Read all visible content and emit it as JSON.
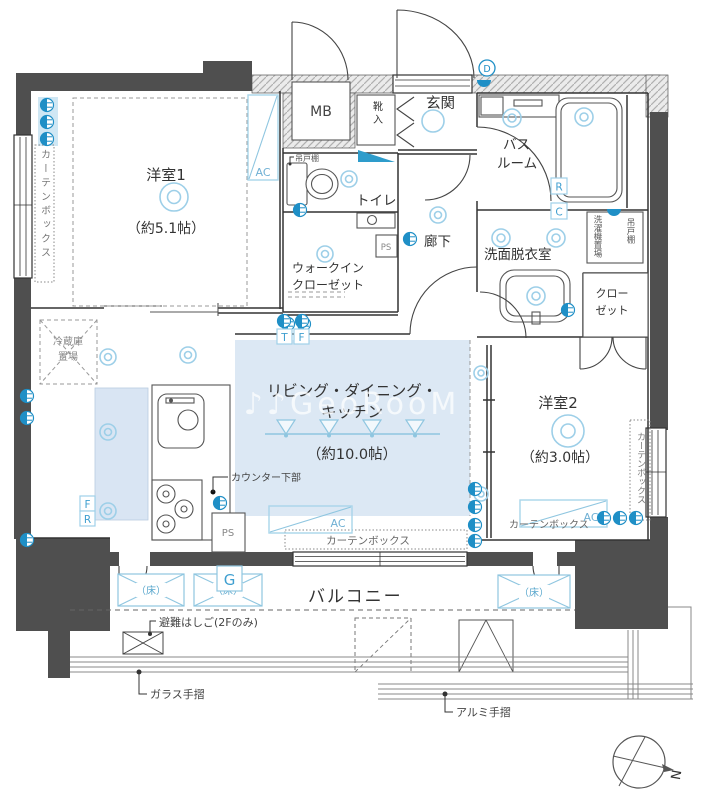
{
  "floorplan": {
    "rooms": {
      "western1": {
        "name": "洋室1",
        "size": "（約5.1帖）"
      },
      "western2": {
        "name": "洋室2",
        "size": "（約3.0帖）"
      },
      "ldk": {
        "name1": "リビング・ダイニング・",
        "name2": "キッチン",
        "size": "（約10.0帖）"
      },
      "entrance": {
        "name": "玄関"
      },
      "toilet": {
        "name": "トイレ"
      },
      "bath": {
        "name1": "バス",
        "name2": "ルーム"
      },
      "hallway": {
        "name": "廊下"
      },
      "washroom": {
        "name": "洗面脱衣室"
      },
      "wic": {
        "name1": "ウォークイン",
        "name2": "クローゼット"
      },
      "closet": {
        "name1": "クロー",
        "name2": "ゼット"
      },
      "balcony": {
        "name": "バルコニー"
      }
    },
    "fixtures": {
      "meter_box": "MB",
      "shoe_box": "靴入",
      "hanging_cabinet_toilet": "吊戸棚",
      "hanging_cabinet_wash": "吊戸棚",
      "washer_space": "洗濯機置場",
      "fridge1": "冷蔵庫",
      "fridge2": "置場",
      "counter_lower": "カウンター下部",
      "ps_kitchen": "PS",
      "ps_toilet": "PS",
      "curtain_left": "カーテンボックス",
      "curtain_right": "カーテンボックス",
      "curtain_ldk": "カーテンボックス",
      "curtain_west2": "カーテンボックス",
      "ac_west1": "AC",
      "ac_ldk": "AC",
      "ac_west2": "AC",
      "floor1": "（床）",
      "floor2": "（床）",
      "floor3": "（床）",
      "gas": "G",
      "escape_ladder": "避難はしご(2Fのみ)",
      "glass_rail": "ガラス手摺",
      "alumi_rail": "アルミ手摺"
    },
    "equipment_letters": {
      "t": "T",
      "f_ldk": "F",
      "f_kitchen": "F",
      "r_kitchen": "R",
      "r_bath": "R",
      "c_bath": "C",
      "d_entrance": "D"
    },
    "compass": {
      "north": "N"
    },
    "watermark": "♪♪GeoRooM",
    "colors": {
      "wall": "#4f4f4f",
      "ldk_fill": "#dce8f4",
      "accent_blue": "#1f8fc6",
      "light_blue": "#8fc6e0"
    }
  }
}
